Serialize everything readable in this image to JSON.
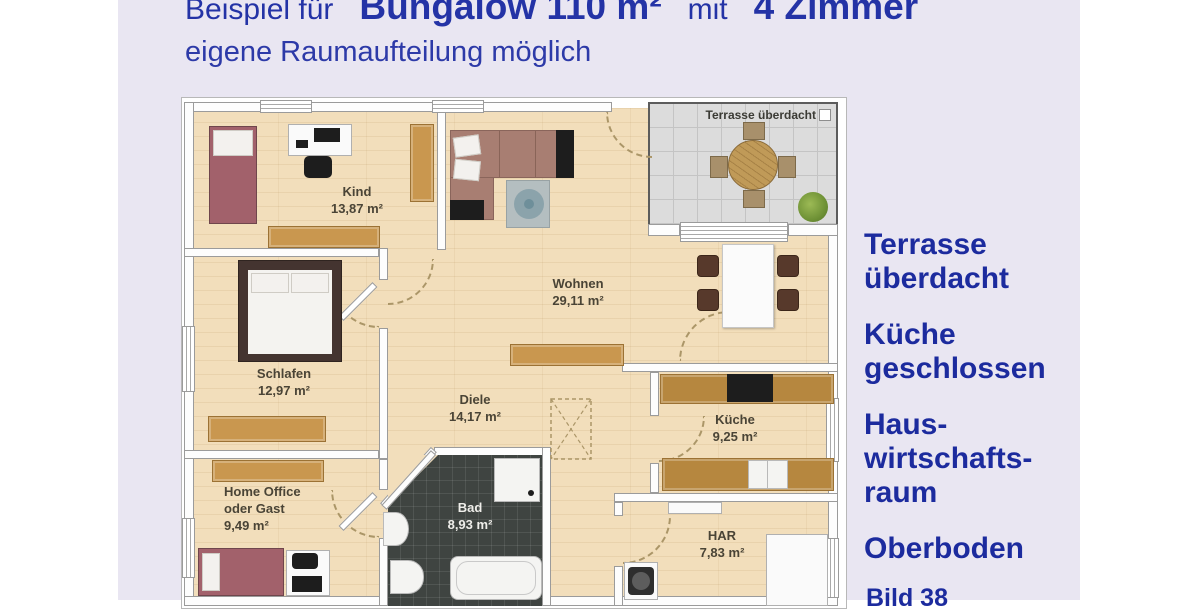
{
  "header": {
    "title_prefix": "Beispiel für",
    "title_main": "Bungalow 110 m²",
    "title_mid": "mit",
    "title_rooms": "4 Zimmer",
    "subtitle": "eigene Raumaufteilung möglich"
  },
  "floorplan": {
    "terrace_label": "Terrasse überdacht",
    "rooms": {
      "kind": {
        "name": "Kind",
        "area": "13,87 m²"
      },
      "wohnen": {
        "name": "Wohnen",
        "area": "29,11 m²"
      },
      "schlafen": {
        "name": "Schlafen",
        "area": "12,97 m²"
      },
      "diele": {
        "name": "Diele",
        "area": "14,17 m²"
      },
      "kueche": {
        "name": "Küche",
        "area": "9,25 m²"
      },
      "homeoffice": {
        "name": "Home Office",
        "name2": "oder Gast",
        "area": "9,49 m²"
      },
      "bad": {
        "name": "Bad",
        "area": "8,93 m²"
      },
      "har": {
        "name": "HAR",
        "area": "7,83 m²"
      }
    }
  },
  "sidebar": {
    "notes": [
      "Terrasse\nüberdacht",
      "Küche\ngeschlossen",
      "Haus-\nwirtschafts-\nraum",
      "Oberboden"
    ],
    "caption": "Bild 38"
  },
  "colors": {
    "title_blue": "#2433a6",
    "note_blue": "#1c2b9e",
    "background_lavender": "#e9e6f2"
  }
}
